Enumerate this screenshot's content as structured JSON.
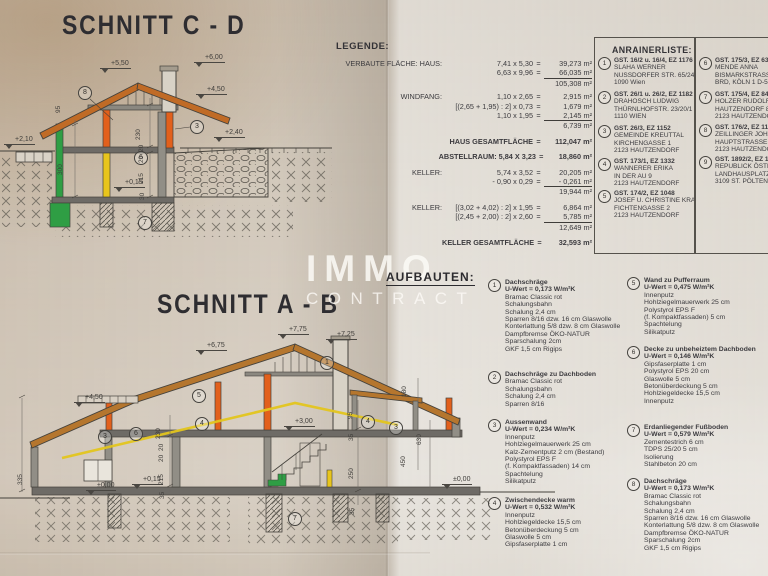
{
  "titles": {
    "schnitt_cd": "SCHNITT  C - D",
    "schnitt_ab": "SCHNITT  A - B",
    "legende": "LEGENDE:",
    "anrainer": "ANRAINERLISTE:",
    "aufbauten": "AUFBAUTEN:"
  },
  "watermark": {
    "line1": "IMMO",
    "line2": "CONTRACT"
  },
  "colors": {
    "roof_brown": "#b5762e",
    "roof_orange": "#c06b26",
    "member_orange": "#e2601c",
    "member_green": "#2f9e44",
    "member_yellow": "#e3c51e",
    "ink": "#3b3a3e",
    "paper_left": "#d8ccbc",
    "paper_right": "#dedbd5"
  },
  "legend": {
    "rows": [
      {
        "l": "VERBAUTE FLÄCHE: HAUS:",
        "e": "7,41 x 5,30",
        "q": "=",
        "v": "39,273 m²"
      },
      {
        "e": "6,63 x 9,96",
        "q": "=",
        "v": "66,035 m²",
        "cls": "sum"
      },
      {
        "v": "105,308 m²"
      },
      {
        "l": "WINDFANG:",
        "e": "1,10 x 2,65",
        "q": "=",
        "v": "2,915 m²",
        "cls": "gap"
      },
      {
        "e": "[(2,65 + 1,95) : 2] x 0,73",
        "q": "=",
        "v": "1,679 m²"
      },
      {
        "e": "1,10 x 1,95",
        "q": "=",
        "v": "2,145 m²",
        "cls": "sum"
      },
      {
        "v": "6,739 m²"
      },
      {
        "e": "HAUS GESAMTFLÄCHE",
        "q": "=",
        "v": "112,047 m²",
        "cls": "bold gap2"
      },
      {
        "e": "ABSTELLRAUM: 5,84 X 3,23",
        "q": "=",
        "v": "18,860 m²",
        "cls": "bold gap2"
      },
      {
        "l": "KELLER:",
        "e": "5,74 x 3,52",
        "q": "=",
        "v": "20,205 m²",
        "cls": "gap2"
      },
      {
        "e": "- 0,90 x 0,29",
        "q": "=",
        "v": "- 0,261 m²",
        "cls": "sum"
      },
      {
        "v": "19,944 m²"
      },
      {
        "l": "KELLER:",
        "e": "[(3,02 + 4,02) : 2] x 1,95",
        "q": "=",
        "v": "6,864 m²",
        "cls": "gap2"
      },
      {
        "e": "[(2,45 + 2,00) : 2] x 2,60",
        "q": "=",
        "v": "5,785 m²",
        "cls": "sum"
      },
      {
        "v": "12,649 m²"
      },
      {
        "e": "KELLER GESAMTFLÄCHE",
        "q": "=",
        "v": "32,593 m²",
        "cls": "bold gap2"
      }
    ]
  },
  "anrainer": {
    "entries": [
      {
        "num": "1",
        "head": "GST. 16/2 u. 16/4, EZ 1176",
        "lines": "SLAHA WERNER\nNUSSDORFER STR. 65/24\n1090 Wien",
        "x": 598,
        "y": 57
      },
      {
        "num": "2",
        "head": "GST. 26/1 u. 26/2, EZ 1182",
        "lines": "DRAHOSCH LUDWIG\nTHÜRNLHOFSTR. 23/20/1\n1110 WIEN",
        "x": 598,
        "y": 91
      },
      {
        "num": "3",
        "head": "GST. 26/3, EZ 1152",
        "lines": "GEMEINDE KREUTTAL\nKIRCHENGASSE 1\n2123 HAUTZENDORF",
        "x": 598,
        "y": 125
      },
      {
        "num": "4",
        "head": "GST. 173/1, EZ 1332",
        "lines": "WANNERER ERIKA\nIN DER AU 9\n2123 HAUTZENDORF",
        "x": 598,
        "y": 158
      },
      {
        "num": "5",
        "head": "GST. 174/2, EZ 1048",
        "lines": "JOSEF U. CHRISTINE KRAUS\nFICHTENGASSE 2\n2123 HAUTZENDORF",
        "x": 598,
        "y": 190
      },
      {
        "num": "6",
        "head": "GST. 175/3, EZ 633",
        "lines": "MENDE ANNA\nBISMARKSTRASSE\nBRD, KÖLN 1 D-50",
        "x": 699,
        "y": 57
      },
      {
        "num": "7",
        "head": "GST. 175/4, EZ 849",
        "lines": "HOLZER RUDOLF\nHAUTZENDORF 86\n2123 HAUTZENDORF",
        "x": 699,
        "y": 91
      },
      {
        "num": "8",
        "head": "GST. 176/2, EZ 1182",
        "lines": "ZEILLINGER JOHANN\nHAUPTSTRASSE 78\n2123 HAUTZENDORF",
        "x": 699,
        "y": 124
      },
      {
        "num": "9",
        "head": "GST. 1892/2, EZ 1151",
        "lines": "REPUBLICK ÖSTERREICH\nLANDHAUSPLATZ 1\n3109 ST. PÖLTEN",
        "x": 699,
        "y": 156
      }
    ]
  },
  "aufbauten": {
    "items": [
      {
        "num": "1",
        "title": "Dachschräge",
        "uwert": "U-Wert = 0,173 W/m²K",
        "body": "Bramac Classic rot\nSchalungsbahn\nSchalung 2,4 cm\nSparren 8/16 dzw. 16 cm Glaswolle\nKonterlattung 5/8 dzw. 8 cm Glaswolle\nDampfbremse ÖKO-NATUR\nSparschalung 2cm\nGKF 1,5 cm Rigips",
        "x": 488,
        "y": 279
      },
      {
        "num": "2",
        "title": "Dachschräge zu Dachboden",
        "uwert": "",
        "body": "Bramac Classic rot\nSchalungsbahn\nSchalung 2,4 cm\nSparren 8/16",
        "x": 488,
        "y": 371
      },
      {
        "num": "3",
        "title": "Aussenwand",
        "uwert": "U-Wert = 0,234 W/m²K",
        "body": "Innenputz\nHohlziegelmauerwerk 25 cm\nKalz-Zementputz 2 cm (Bestand)\nPolystyrol EPS F\n(f. Kompaktfassaden) 14 cm\nSpachtelung\nSilikatputz",
        "x": 488,
        "y": 419
      },
      {
        "num": "4",
        "title": "Zwischendecke warm",
        "uwert": "U-Wert = 0,532 W/m²K",
        "body": "Innenputz\nHohlziegeldecke 15,5 cm\nBetonüberdeckung 5 cm\nGlaswolle 5 cm\nGipsfaserplatte 1 cm",
        "x": 488,
        "y": 497
      },
      {
        "num": "5",
        "title": "Wand zu Pufferraum",
        "uwert": "U-Wert = 0,475 W/m²K",
        "body": "Innenputz\nHohlziegelmauerwerk 25 cm\nPolystyrol EPS F\n(f. Kompaktfassaden) 5 cm\nSpachtelung\nSilikatputz",
        "x": 627,
        "y": 277
      },
      {
        "num": "6",
        "title": "Decke zu unbeheiztem Dachboden",
        "uwert": "U-Wert = 0,146 W/m²K",
        "body": "Gipsfaserplatte 1 cm\nPolystyrol EPS 20 cm\nGlaswolle 5 cm\nBetonüberdeckung 5 cm\nHohlziegeldecke 15,5 cm\nInnenputz",
        "x": 627,
        "y": 346
      },
      {
        "num": "7",
        "title": "Erdanliegender Fußboden",
        "uwert": "U-Wert = 0,579 W/m²K",
        "body": "Zementestrich 6 cm\nTDPS 25/20 5 cm\nIsolierung\nStahlbeton 20 cm",
        "x": 627,
        "y": 424
      },
      {
        "num": "8",
        "title": "Dachschräge",
        "uwert": "U-Wert = 0,173 W/m²K",
        "body": "Bramac Classic rot\nSchalungsbahn\nSchalung 2,4 cm\nSparren 8/16 dzw. 16 cm Glaswolle\nKonterlattung 5/8 dzw. 8 cm Glaswolle\nDampfbremse ÖKO-NATUR\nSparschalung 2cm\nGKF 1,5 cm Rigips",
        "x": 627,
        "y": 478
      }
    ]
  },
  "cd_labels": [
    {
      "t": "+5,50",
      "x": 100,
      "y": 60,
      "cls": "lvl"
    },
    {
      "t": "+6,00",
      "x": 194,
      "y": 54,
      "cls": "lvl"
    },
    {
      "t": "+4,50",
      "x": 196,
      "y": 86,
      "cls": "lvl"
    },
    {
      "t": "+2,40",
      "x": 214,
      "y": 129,
      "cls": "lvl"
    },
    {
      "t": "+2,10",
      "x": 4,
      "y": 136,
      "cls": "lvl"
    },
    {
      "t": "+0,15",
      "x": 114,
      "y": 179,
      "cls": "lvl"
    },
    {
      "t": "8",
      "x": 78,
      "y": 86,
      "cls": "circ"
    },
    {
      "t": "3",
      "x": 190,
      "y": 120,
      "cls": "circ"
    },
    {
      "t": "6",
      "x": 134,
      "y": 151,
      "cls": "circ"
    },
    {
      "t": "7",
      "x": 138,
      "y": 216,
      "cls": "circ"
    },
    {
      "t": "95",
      "x": 62,
      "y": 106,
      "cls": "rot"
    },
    {
      "t": "300",
      "x": 64,
      "y": 168,
      "cls": "rot"
    },
    {
      "t": "230",
      "x": 142,
      "y": 133,
      "cls": "rot"
    },
    {
      "t": "20",
      "x": 145,
      "y": 145,
      "cls": "rot"
    },
    {
      "t": "20",
      "x": 145,
      "y": 156,
      "cls": "rot"
    },
    {
      "t": "215",
      "x": 145,
      "y": 177,
      "cls": "rot"
    },
    {
      "t": "30",
      "x": 146,
      "y": 193,
      "cls": "rot"
    }
  ],
  "ab_labels": [
    {
      "t": "+7,75",
      "x": 278,
      "y": 326,
      "cls": "lvl"
    },
    {
      "t": "+7,25",
      "x": 326,
      "y": 331,
      "cls": "lvl"
    },
    {
      "t": "+6,75",
      "x": 196,
      "y": 342,
      "cls": "lvl"
    },
    {
      "t": "+4,50",
      "x": 74,
      "y": 394,
      "cls": "lvl"
    },
    {
      "t": "+3,00",
      "x": 284,
      "y": 418,
      "cls": "lvl"
    },
    {
      "t": "+0,15",
      "x": 132,
      "y": 476,
      "cls": "lvl"
    },
    {
      "t": "±0,00",
      "x": 86,
      "y": 482,
      "cls": "lvl"
    },
    {
      "t": "±0,00",
      "x": 442,
      "y": 476,
      "cls": "lvl"
    },
    {
      "t": "1",
      "x": 320,
      "y": 356,
      "cls": "circ"
    },
    {
      "t": "5",
      "x": 192,
      "y": 389,
      "cls": "circ"
    },
    {
      "t": "3",
      "x": 98,
      "y": 430,
      "cls": "circ"
    },
    {
      "t": "6",
      "x": 129,
      "y": 427,
      "cls": "circ"
    },
    {
      "t": "4",
      "x": 195,
      "y": 417,
      "cls": "circ"
    },
    {
      "t": "4",
      "x": 361,
      "y": 415,
      "cls": "circ"
    },
    {
      "t": "3",
      "x": 389,
      "y": 421,
      "cls": "circ"
    },
    {
      "t": "7",
      "x": 288,
      "y": 512,
      "cls": "circ"
    },
    {
      "t": "335",
      "x": 24,
      "y": 478,
      "cls": "rot"
    },
    {
      "t": "230",
      "x": 162,
      "y": 432,
      "cls": "rot"
    },
    {
      "t": "20",
      "x": 165,
      "y": 444,
      "cls": "rot"
    },
    {
      "t": "20",
      "x": 165,
      "y": 455,
      "cls": "rot"
    },
    {
      "t": "215",
      "x": 165,
      "y": 478,
      "cls": "rot"
    },
    {
      "t": "35",
      "x": 166,
      "y": 492,
      "cls": "rot"
    },
    {
      "t": "95",
      "x": 354,
      "y": 412,
      "cls": "rot"
    },
    {
      "t": "35",
      "x": 355,
      "y": 434,
      "cls": "rot"
    },
    {
      "t": "250",
      "x": 355,
      "y": 472,
      "cls": "rot"
    },
    {
      "t": "35",
      "x": 356,
      "y": 508,
      "cls": "rot"
    },
    {
      "t": "450",
      "x": 407,
      "y": 460,
      "cls": "rot"
    },
    {
      "t": "630",
      "x": 423,
      "y": 438,
      "cls": "rot"
    },
    {
      "t": "180",
      "x": 408,
      "y": 390,
      "cls": "rot"
    }
  ]
}
